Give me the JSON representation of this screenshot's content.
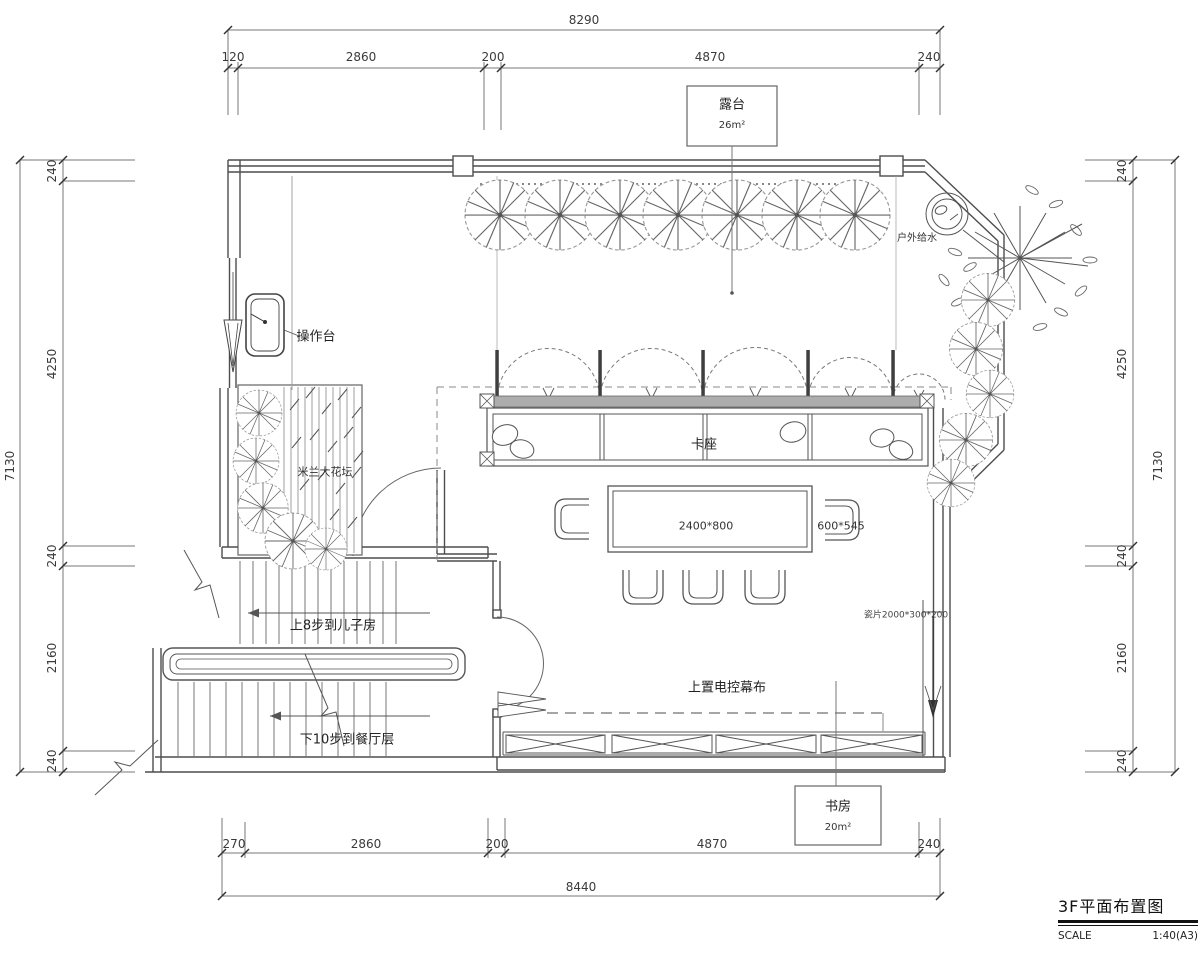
{
  "title_block": {
    "title": "3F平面布置图",
    "scale_label": "SCALE",
    "scale_value": "1:40(A3)"
  },
  "dimensions": {
    "top": {
      "overall": "8290",
      "segments": [
        "120",
        "2860",
        "200",
        "4870",
        "240"
      ]
    },
    "bottom": {
      "overall": "8440",
      "segments": [
        "270",
        "2860",
        "200",
        "4870",
        "240"
      ]
    },
    "left": {
      "overall": "7130",
      "segments": [
        "240",
        "4250",
        "240",
        "2160",
        "240"
      ]
    },
    "right": {
      "overall": "7130",
      "segments": [
        "240",
        "4250",
        "240",
        "2160",
        "240"
      ]
    }
  },
  "rooms": {
    "terrace": {
      "name": "露台",
      "area": "26m²"
    },
    "study": {
      "name": "书房",
      "area": "20m²"
    }
  },
  "labels": {
    "operation_counter": "操作台",
    "planter": "米兰大花坛",
    "booth": "卡座",
    "table_size": "2400*800",
    "chair_size": "600*545",
    "outdoor_water": "户外给水",
    "screen": "上置电控幕布",
    "stair_up": "上8步到儿子房",
    "stair_down": "下10步到餐厅层",
    "tile_note": "瓷片2000*300*200"
  },
  "colors": {
    "line": "#555555",
    "dim_line": "#777777",
    "text": "#333333",
    "wall_band": "#adadad"
  }
}
